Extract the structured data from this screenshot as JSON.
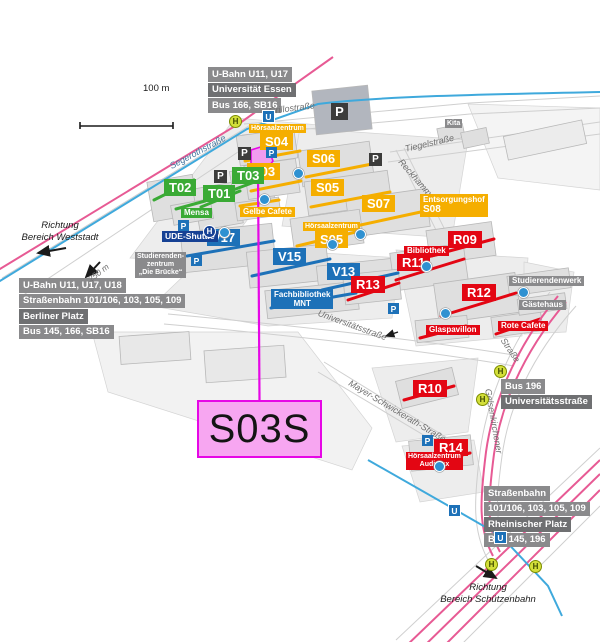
{
  "highlight": {
    "label": "S03S"
  },
  "scale_bar": {
    "label": "100 m"
  },
  "icons": {
    "parking": "P",
    "ubahn": "U",
    "tram_stop": "H"
  },
  "labels": {
    "hoersaalzentrum": "Hörsaalzentrum"
  },
  "buildings": {
    "s03": "S03",
    "s04": "S04",
    "s05": "S05",
    "s06": "S06",
    "s07": "S07",
    "s08_sup": "Entsorgungshof",
    "s08": "S08",
    "t01": "T01",
    "t02": "T02",
    "t03": "T03",
    "v13": "V13",
    "v15": "V15",
    "v17": "V17",
    "r09": "R09",
    "r10": "R10",
    "r11": "R11",
    "r12": "R12",
    "r13": "R13",
    "r14": "R14",
    "audimax": "Audimax"
  },
  "facilities": {
    "mensa": "Mensa",
    "gelbe_cafete": "Gelbe Cafete",
    "rote_cafete": "Rote Cafete",
    "bibliothek": "Bibliothek",
    "fachbibliothek_1": "Fachbibliothek",
    "fachbibliothek_2": "MNT",
    "glaspavillon": "Glaspavillon",
    "ude_shuttle": "UDE-Shuttle",
    "studierendenzentrum": [
      "Studierenden-",
      "zentrum",
      "„Die Brücke“"
    ],
    "studierendenwerk": "Studierendenwerk",
    "gaestehaus": "Gästehaus",
    "kita": "Kita"
  },
  "streets": {
    "grillostrasse": "Grillostraße",
    "segerothstrasse": "Segerothstraße",
    "tiegelstrasse": "Tiegelstraße",
    "reckhammerweg": "Reckhammerweg",
    "universitaetsstrasse": "Universitätsstraße",
    "mayer_schwickerath": "Mayer-Schwickerath-Straße",
    "gelsenkirchener": "Gelsenkirchener",
    "strasse": "Straße"
  },
  "transit": {
    "top": {
      "lines": [
        "U-Bahn U11, U17",
        "Universität Essen",
        "Bus 166, SB16"
      ]
    },
    "left": {
      "lines": [
        "U-Bahn U11, U17, U18",
        "Straßenbahn 101/106, 103, 105, 109",
        "Berliner Platz",
        "Bus 145, 166, SB16"
      ]
    },
    "right": {
      "lines": [
        "Bus 196",
        "Universitätsstraße"
      ]
    },
    "bottom": {
      "lines": [
        "Straßenbahn",
        "101/106, 103, 105, 109",
        "Rheinischer Platz",
        "Bus 145, 196"
      ]
    }
  },
  "directions": {
    "west_1": "Richtung",
    "west_2": "Bereich Weststadt",
    "south_1": "Richtung",
    "south_2": "Bereich Schützenbahn",
    "distance": "250 m"
  }
}
